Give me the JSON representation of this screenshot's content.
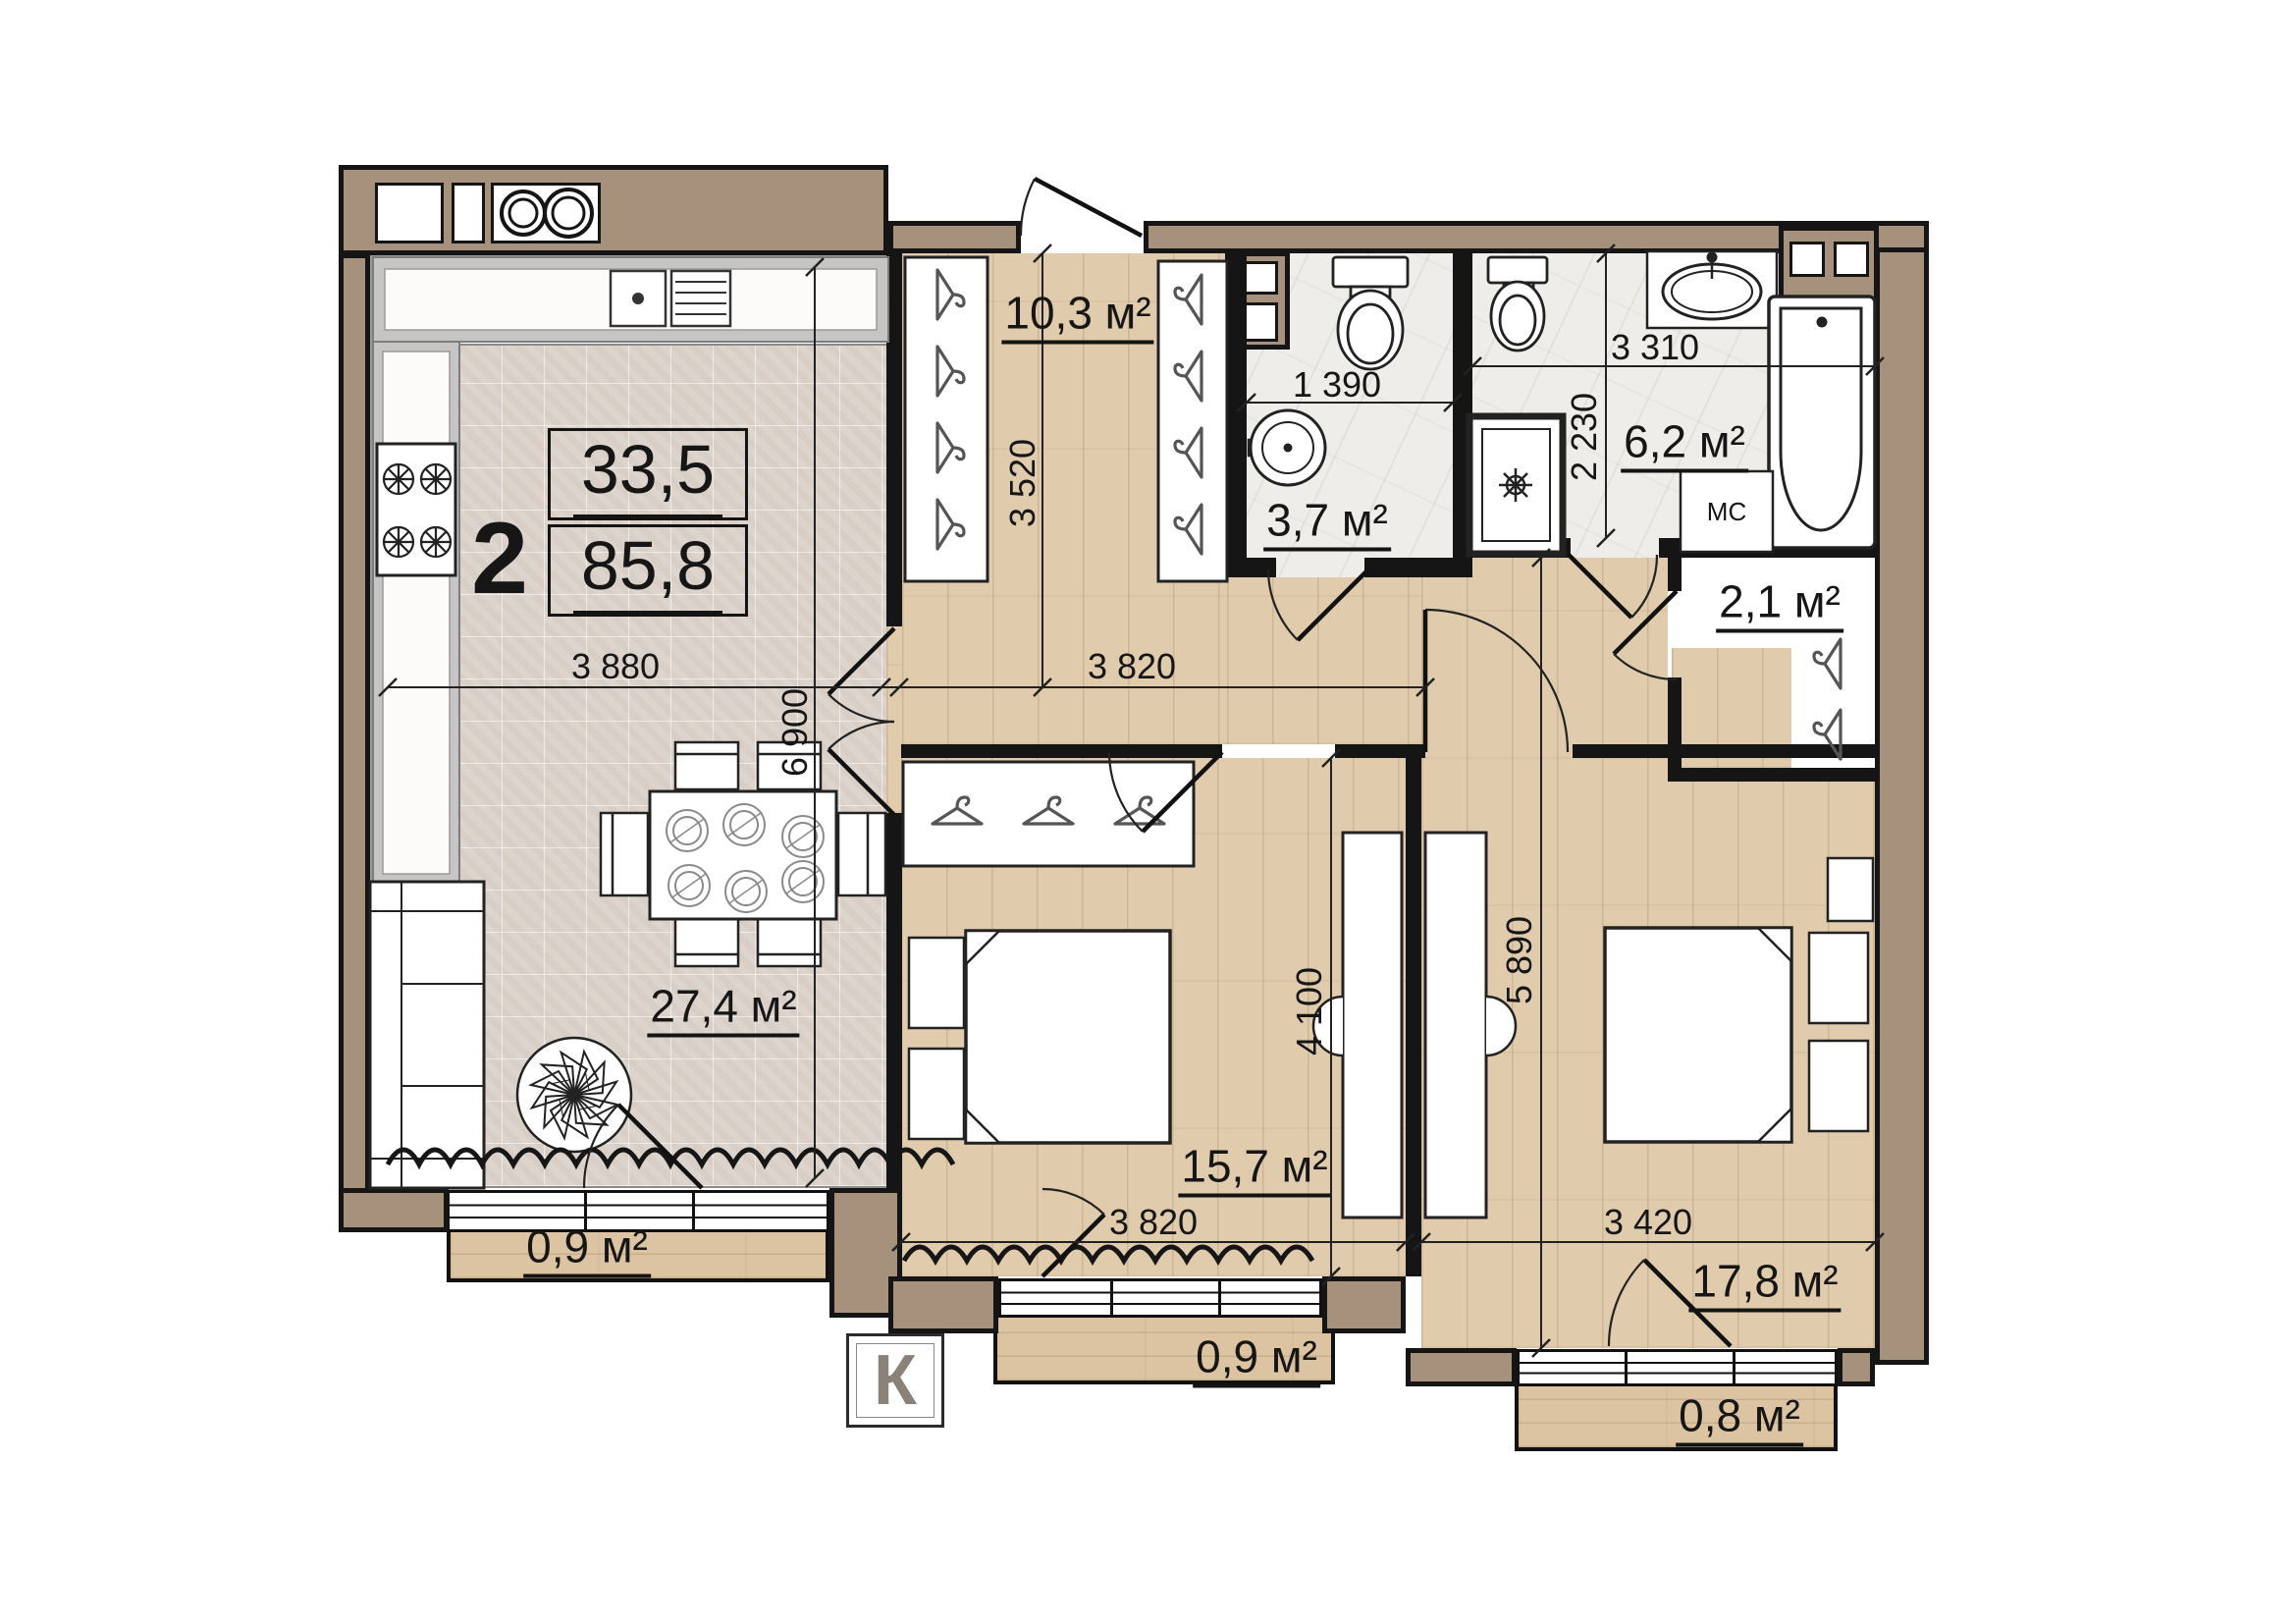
{
  "plan": {
    "unit_info": {
      "rooms_count": "2",
      "living_area": "33,5",
      "total_area": "85,8"
    },
    "areas": {
      "hallway": "10,3 м²",
      "bathroom_small": "3,7 м²",
      "bathroom_large": "6,2 м²",
      "closet": "2,1 м²",
      "kitchen_living": "27,4 м²",
      "bedroom_1": "15,7 м²",
      "bedroom_2": "17,8 м²",
      "balcony_left": "0,9 м²",
      "balcony_middle": "0,9 м²",
      "balcony_right": "0,8 м²"
    },
    "dims": {
      "living_w": "3 880",
      "living_h": "6 900",
      "hall_w": "3 820",
      "hall_h": "3 520",
      "bath_small_w": "1 390",
      "bath_large_w": "3 310",
      "bath_large_h": "2 230",
      "bed1_w": "3 820",
      "bed1_h": "4 100",
      "bed2_w": "3 420",
      "bed2_h": "5 890"
    },
    "labels": {
      "washing_machine": "МС",
      "ac_box": "К"
    }
  },
  "colors": {
    "wall": "#a6927c",
    "floor_tile": "#ddd5cd",
    "floor_wood": "#e0cbac",
    "floor_marble": "#efede9",
    "counter": "#c7c5c3",
    "ink": "#161616",
    "muted": "#8a8278"
  }
}
